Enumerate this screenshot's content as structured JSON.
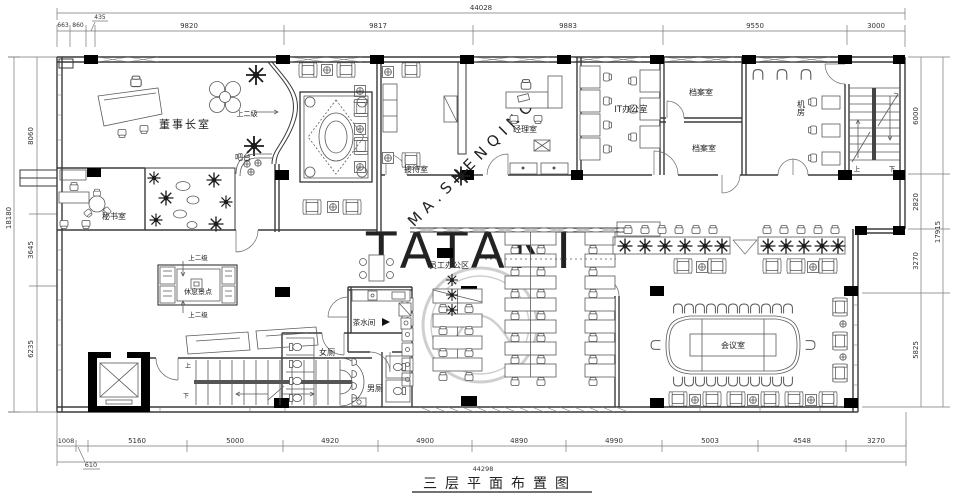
{
  "title": {
    "text": "三层平面布置图"
  },
  "watermarks": {
    "diagonal": "MA.SHENQING",
    "brand": "TATANI"
  },
  "dimensions": {
    "top": {
      "total": "44028",
      "segments": [
        "663",
        "860",
        "435",
        "9820",
        "9817",
        "9883",
        "9550",
        "3000"
      ]
    },
    "bottom": {
      "total": "44298",
      "segments": [
        "1008",
        "610",
        "5160",
        "5000",
        "4920",
        "4900",
        "4890",
        "4990",
        "5003",
        "4548",
        "3270"
      ]
    },
    "left": {
      "total": "18180",
      "segments": [
        "8060",
        "3645",
        "6235"
      ]
    },
    "right": {
      "total": "17915",
      "segments": [
        "6000",
        "2820",
        "3270",
        "5825"
      ]
    }
  },
  "rooms": {
    "chairman": "董事长室",
    "secretary": "秘书室",
    "bar": "吧台",
    "reception": "接待室",
    "manager": "经理室",
    "it_office": "IT办公室",
    "archive_1": "档案室",
    "archive_2": "档案室",
    "server": "机房",
    "staff_area": "员工办公区",
    "rest_spot": "休息景点",
    "tea_room": "茶水间",
    "womens": "女厕",
    "mens": "男厕",
    "meeting": "会议室"
  },
  "annotations": {
    "up_two_a": "上二级",
    "up_two_b": "上二级",
    "up_two_c": "上二级",
    "up_a": "上",
    "down_a": "下",
    "up_b": "上",
    "down_b": "下"
  }
}
